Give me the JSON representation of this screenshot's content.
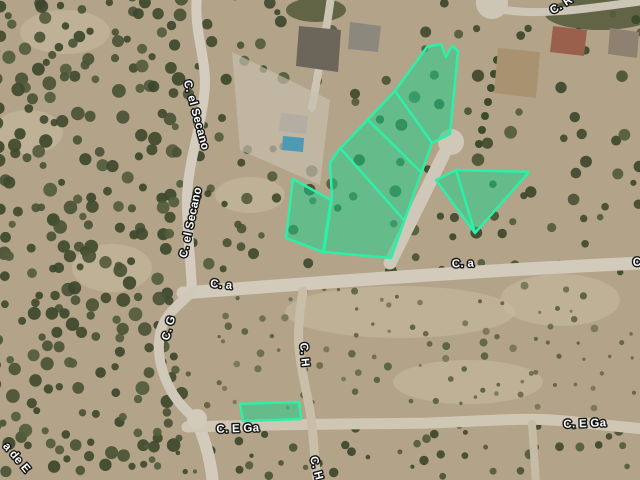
{
  "map": {
    "type": "satellite-aerial-view",
    "colors": {
      "terrain": "#b3a489",
      "road": "#d2cabb",
      "parcel_fill": "#17d38b",
      "parcel_fill_opacity": 0.5,
      "parcel_stroke": "#2cf0a8",
      "parcel_stroke_width": 2.5,
      "label_fill": "#ffffff",
      "label_outline": "#161616"
    },
    "street_labels": [
      {
        "text": "C. el Secano",
        "x": 193,
        "y": 116,
        "rot": 75
      },
      {
        "text": "C. el Secano",
        "x": 194,
        "y": 223,
        "rot": -78
      },
      {
        "text": "C. a",
        "x": 221,
        "y": 288,
        "rot": 6
      },
      {
        "text": "C. a",
        "x": 463,
        "y": 267,
        "rot": -2
      },
      {
        "text": "C",
        "x": 637,
        "y": 266,
        "rot": 0
      },
      {
        "text": "C. G",
        "x": 172,
        "y": 329,
        "rot": -75
      },
      {
        "text": "C. H",
        "x": 301,
        "y": 355,
        "rot": 85
      },
      {
        "text": "C. H",
        "x": 313,
        "y": 469,
        "rot": 75
      },
      {
        "text": "C. E Ga",
        "x": 238,
        "y": 432,
        "rot": -2
      },
      {
        "text": "C. E Ga",
        "x": 585,
        "y": 427,
        "rot": -2
      },
      {
        "text": "C. R",
        "x": 563,
        "y": 8,
        "rot": -32
      },
      {
        "text": "a de E",
        "x": 14,
        "y": 460,
        "rot": 50
      }
    ],
    "parcels": [
      {
        "name": "parcel-band-cluster",
        "outline": [
          [
            395,
            91
          ],
          [
            427,
            47
          ],
          [
            441,
            44
          ],
          [
            446,
            57
          ],
          [
            452,
            46
          ],
          [
            458,
            51
          ],
          [
            450,
            134
          ],
          [
            432,
            143
          ],
          [
            391,
            258
          ],
          [
            324,
            252
          ],
          [
            332,
            197
          ],
          [
            330,
            163
          ],
          [
            338,
            151
          ]
        ],
        "divisions": [
          [
            [
              395,
              91
            ],
            [
              432,
              143
            ]
          ],
          [
            [
              368,
              120
            ],
            [
              421,
              172
            ]
          ],
          [
            [
              341,
              149
            ],
            [
              404,
              220
            ]
          ]
        ]
      },
      {
        "name": "parcel-left-quad",
        "outline": [
          [
            293,
            179
          ],
          [
            331,
            200
          ],
          [
            323,
            252
          ],
          [
            286,
            238
          ]
        ],
        "divisions": []
      },
      {
        "name": "parcel-right-triangle",
        "outline": [
          [
            436,
            180
          ],
          [
            456,
            170
          ],
          [
            529,
            172
          ],
          [
            475,
            233
          ]
        ],
        "divisions": [
          [
            [
              456,
              170
            ],
            [
              475,
              233
            ]
          ]
        ]
      },
      {
        "name": "parcel-small-rect",
        "outline": [
          [
            240,
            404
          ],
          [
            299,
            402
          ],
          [
            301,
            419
          ],
          [
            243,
            421
          ]
        ],
        "divisions": []
      }
    ]
  }
}
